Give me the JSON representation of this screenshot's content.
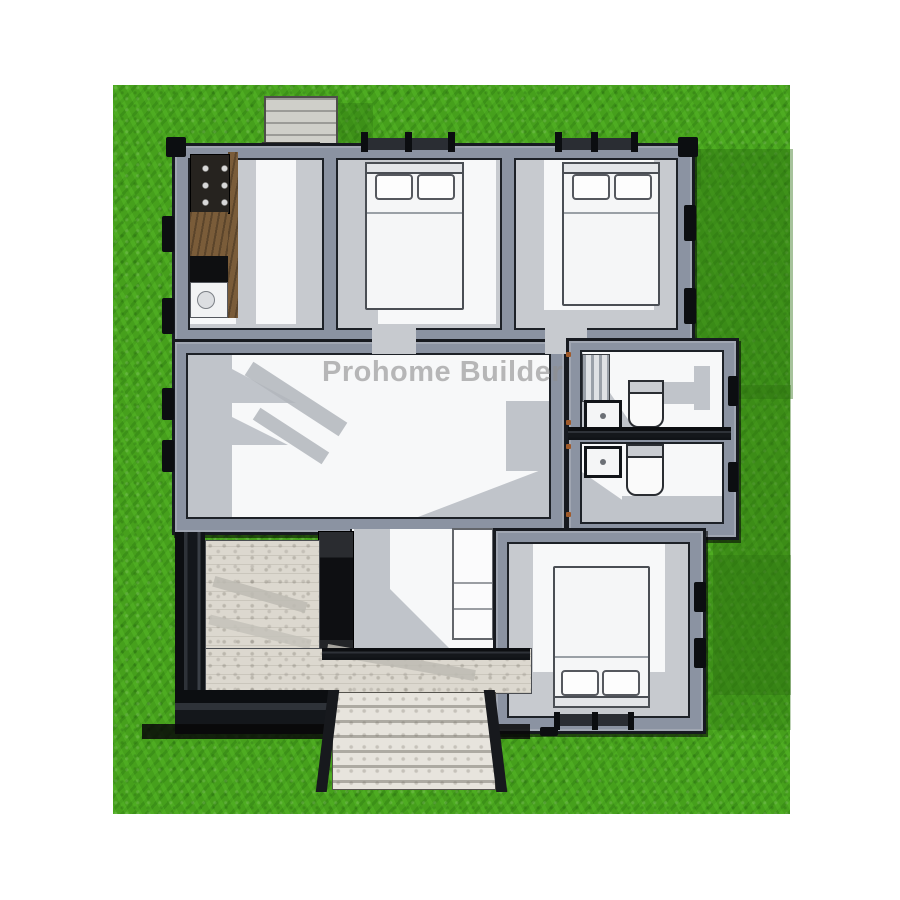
{
  "watermark": {
    "text": "Prohome Builder"
  },
  "colors": {
    "grass_base": "#46a01c",
    "grass_shadow": "#2c6e10",
    "wall_dark": "#171a20",
    "wall_gray": "#8b93a2",
    "floor_white": "#f7f8f9",
    "floor_gray": "#c7cacf",
    "tile": "#dcd8cf",
    "wood_counter": "#7a5c39",
    "bed_white": "#f5f6f7",
    "watermark_gray": "#8f8f8f"
  },
  "scene": {
    "type": "3d-top-view-floor-plan",
    "rooms": [
      "kitchen",
      "bedroom-top-left",
      "bedroom-top-right",
      "living-area",
      "bathroom-upper",
      "bathroom-lower",
      "bedroom-bottom",
      "entry-hall",
      "porch"
    ],
    "fixtures": [
      "kitchen-stove",
      "kitchen-counter",
      "kitchen-sink",
      "bed",
      "bed",
      "bed",
      "toilet",
      "toilet",
      "bathroom-sink",
      "bathroom-sink",
      "cabinet",
      "front-stairs",
      "back-steps",
      "back-ladder"
    ]
  }
}
